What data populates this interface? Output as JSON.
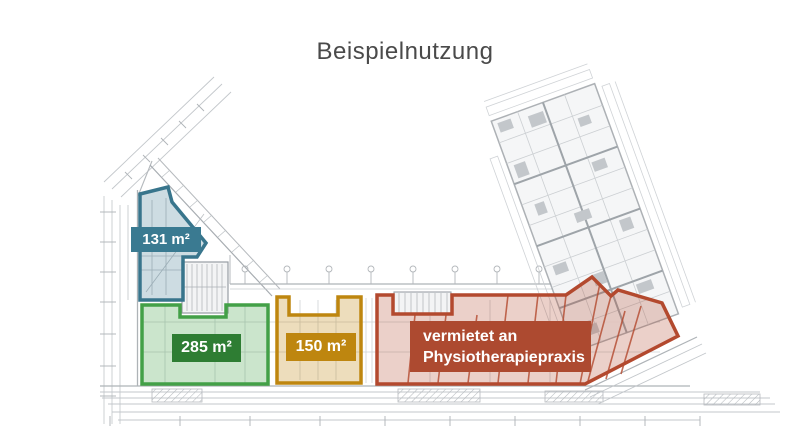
{
  "title": "Beispielnutzung",
  "zones": {
    "blue": {
      "area_label": "131 m²",
      "outline_color": "#38758C",
      "badge_color": "#3A7A91",
      "fill_color": "rgba(56,117,140,0.25)"
    },
    "green": {
      "area_label": "285 m²",
      "outline_color": "#43A047",
      "badge_color": "#2E7D33",
      "fill_color": "rgba(67,160,71,0.28)"
    },
    "orange": {
      "area_label": "150 m²",
      "outline_color": "#BE860F",
      "badge_color": "#BE860F",
      "fill_color": "rgba(190,134,15,0.28)"
    },
    "red": {
      "status_line1": "vermietet an",
      "status_line2": "Physiotherapiepraxis",
      "outline_color": "#B3492E",
      "badge_color": "#AD4A30",
      "fill_color": "rgba(179,73,46,0.26)"
    }
  }
}
